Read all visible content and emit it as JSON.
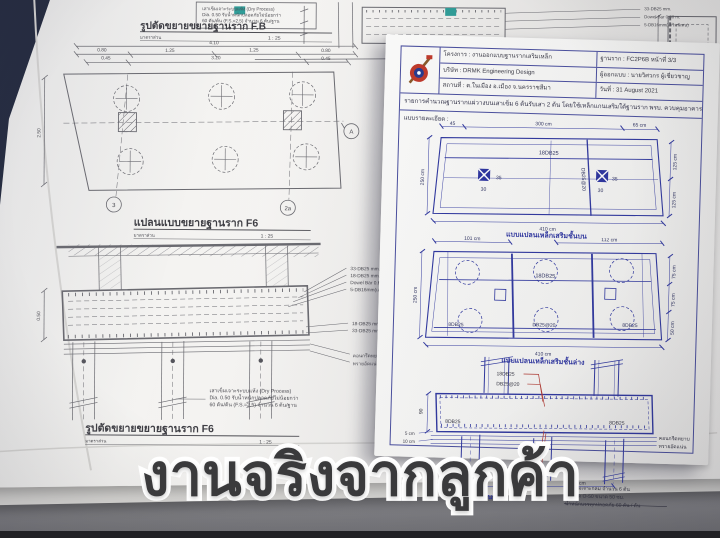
{
  "caption": "งานจริงจากลูกค้า",
  "colors": {
    "blueprint_blue": "#3038a0",
    "pencil_gray": "#63636a",
    "red_leader": "#b23a32",
    "teal_mark": "#2f9d98",
    "caption_fill": "#3a3a3c",
    "navy_background": "#20273b"
  },
  "left_sheet": {
    "title_top": "รูปตัดขยายขยายฐานราก F.B",
    "title_plan": "แปลนแบบขยายฐานราก F6",
    "title_bottom": "รูปตัดขยายขยายฐานราก F6",
    "scale_label": "มาตราส่วน",
    "scale_value": "1 : 25",
    "note_lines": [
      "เสาเข็มเจาะระบบแห้ง (Dry Process)",
      "Dia. 0.50 รับน้ำหนักปลอดภัยไม่น้อยกว่า",
      "60 ตัน/ต้น (F.S.=2.5) จำนวน 6 ต้น/ฐาน"
    ],
    "dims_total": "4.10",
    "dims_row2": [
      "0.80",
      "1.25",
      "1.25",
      "0.80"
    ],
    "dims_row3": [
      "0.45",
      "3.20",
      "0.45"
    ],
    "dim_plan_left": "2.50",
    "dim_footing_depth": "0.50",
    "grid_bubbles": {
      "a": "A",
      "r3": "3",
      "r2a": "2a"
    },
    "section_labels": [
      "33-DB25 mm.",
      "18-DB25 mm.",
      "Dowel Bar 0.60 m.",
      "5-DB16mm(เสริมพิเศษ)",
      "18-DB25 mm.",
      "33-DB25 mm.",
      "คอนกรีตหยาบ",
      "ทรายอัดแน่น"
    ],
    "top_right_labels": [
      "33-DB25 mm.",
      "Dowel Bar 0.60 m.",
      "5-DB16mm(เสริมพิเศษ)"
    ]
  },
  "right_sheet": {
    "header_rows": [
      "โครงการ : งานออกแบบฐานรากเสริมเหล็ก",
      "บริษัท : DRMK Engineering Design",
      "สถานที่ : ต.ในเมือง อ.เมือง จ.นครราชสีมา"
    ],
    "header_right": [
      "ฐานราก : FC2P6B หน้าที่ 3/3",
      "ผู้ออกแบบ : นายวิศวกร ผู้เชี่ยวชาญ",
      "วันที่ : 31 August 2021"
    ],
    "description": "รายการคำนวณฐานรากแผ่วางบนเสาเข็ม 6 ต้นรับเสา 2 ต้น โดยใช้เหล็กแกนเสริมใต้ฐานราก พรบ. ควบคุมอาคาร",
    "details_label": "แบบรายละเอียด :",
    "d1": {
      "caption": "แบบแปลนเหล็กเสริมชั้นบน",
      "dim_45": "45",
      "dim_300": "300 cm",
      "dim_65": "65 cm",
      "dim_250": "250 cm",
      "dim_125a": "125 cm",
      "dim_125b": "125 cm",
      "dim_410": "410 cm",
      "bar_top": "18DB25",
      "bar_vert": "DB25@20",
      "col_35": "35",
      "col_30": "30"
    },
    "d2": {
      "caption": "แบบแปลนเหล็กเสริมชั้นล่าง",
      "dim_101": "101 cm",
      "dim_112": "112 cm",
      "dim_250": "250 cm",
      "dim_75a": "75 cm",
      "dim_75b": "75 cm",
      "dim_50": "50 cm",
      "dim_410": "410 cm",
      "bar_top": "18DB25",
      "bar_bl": "8DB25",
      "bar_bc": "DB25@20",
      "bar_br": "8DB25"
    },
    "d3": {
      "caption": "แบบด้านข้าง",
      "lbl_18_top": "18DB25",
      "lbl_2520_top": "DB25@20",
      "lbl_2520_bot": "DB25@20",
      "lbl_18_bot": "18DB25",
      "lbl_8_left": "8DB25",
      "lbl_8_right": "8DB25",
      "dim_90": "90",
      "dim_5": "5 cm",
      "dim_10": "10 cm",
      "dim_155a": "155 cm",
      "dim_155b": "155 cm",
      "note_concrete": "คอนกรีตหยาบ",
      "note_sand": "ทรายอัดแน่น",
      "pile_notes": [
        "เสาเข็มเจาะกลม จำนวน 6 ต้น",
        "หน้าตัด O-50 ขนาด 50 ซม.",
        "น้ำหนักบรรทุกปลอดภัย 60 ตัน / ต้น"
      ]
    }
  }
}
